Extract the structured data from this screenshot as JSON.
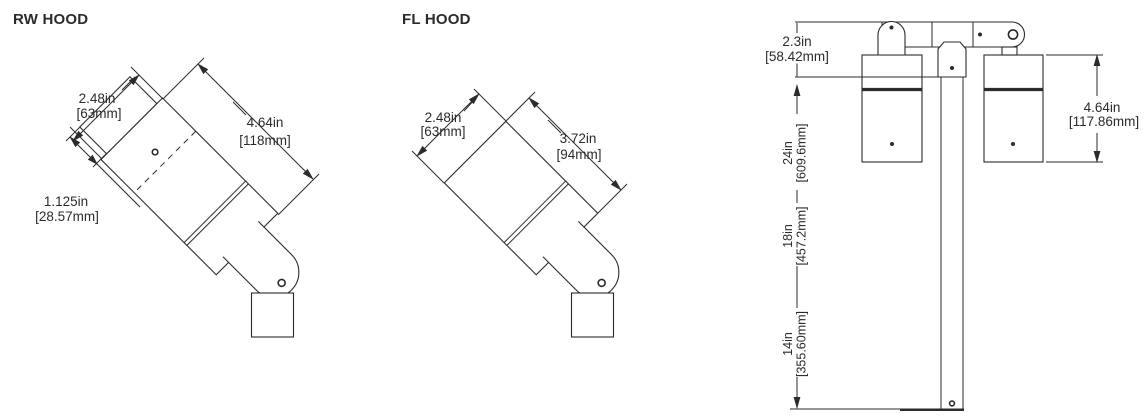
{
  "colors": {
    "line": "#2b2b2b",
    "background": "#ffffff"
  },
  "rw_hood": {
    "title": "RW HOOD",
    "width_in": "2.48in",
    "width_mm": "[63mm]",
    "length_in": "4.64in",
    "length_mm": "[118mm]",
    "cap_in": "1.125in",
    "cap_mm": "[28.57mm]"
  },
  "fl_hood": {
    "title": "FL HOOD",
    "width_in": "2.48in",
    "width_mm": "[63mm]",
    "length_in": "3.72in",
    "length_mm": "[94mm]"
  },
  "pole_view": {
    "arm_height_in": "2.3in",
    "arm_height_mm": "[58.42mm]",
    "fixture_height_in": "4.64in",
    "fixture_height_mm": "[117.86mm]",
    "mount_heights": [
      {
        "in_value": "24in",
        "mm_value": "[609.6mm]"
      },
      {
        "in_value": "18in",
        "mm_value": "[457.2mm]"
      },
      {
        "in_value": "14in",
        "mm_value": "[355.60mm]"
      }
    ]
  }
}
